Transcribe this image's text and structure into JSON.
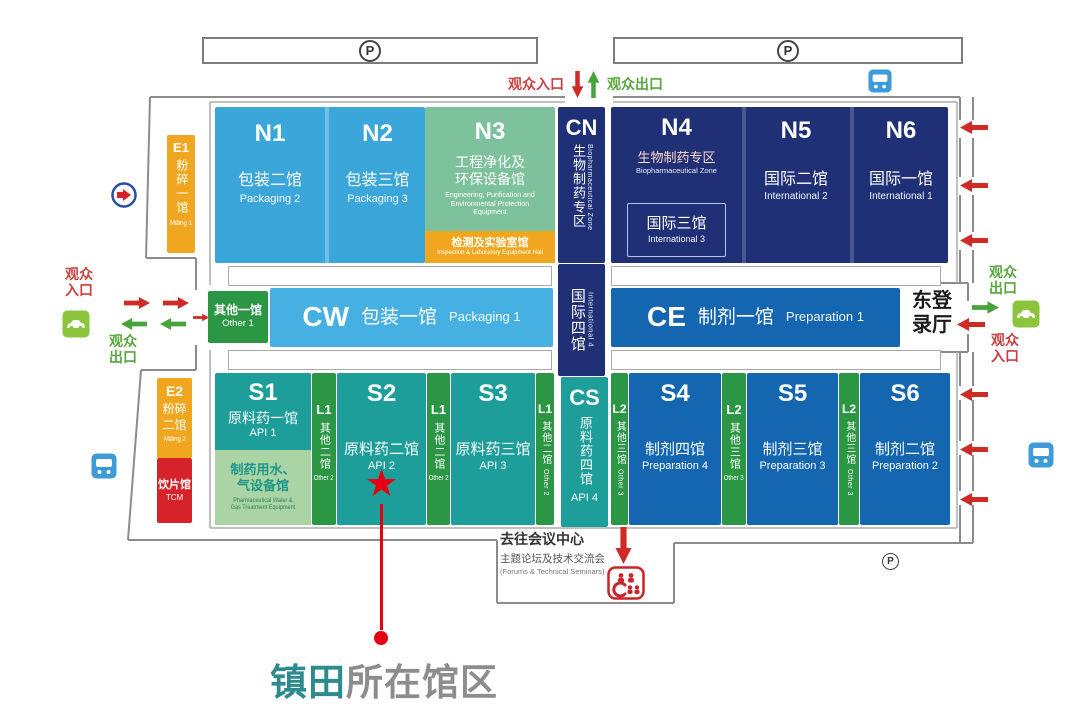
{
  "annotation": {
    "highlight": "镇田",
    "rest": "所在馆区"
  },
  "parking_label": "P",
  "icons": {
    "star": "★"
  },
  "labels": {
    "visitor_entrance": "观众入口",
    "visitor_exit": "观众出口",
    "visitor_entrance_l1": "观众",
    "visitor_entrance_l2": "入口",
    "visitor_exit_l1": "观众",
    "visitor_exit_l2": "出口",
    "east_hall_l1": "东登",
    "east_hall_l2": "录厅",
    "conference_title": "去往会议中心",
    "conference_sub": "主题论坛及技术交流会",
    "conference_en": "(Forums & Technical Seminars)"
  },
  "halls": {
    "e1": {
      "code": "E1",
      "name": "粉碎一馆",
      "en": "Milling 1"
    },
    "e2": {
      "code": "E2",
      "name_l1": "粉碎",
      "name_l2": "二馆",
      "en": "Milling 2"
    },
    "tcm": {
      "name": "饮片馆",
      "en": "TCM"
    },
    "n1": {
      "code": "N1",
      "name": "包装二馆",
      "en": "Packaging 2"
    },
    "n2": {
      "code": "N2",
      "name": "包装三馆",
      "en": "Packaging 3"
    },
    "n3": {
      "code": "N3",
      "name_l1": "工程净化及",
      "name_l2": "环保设备馆",
      "en": "Engineering, Purification and Environmental Protection Equipment"
    },
    "n3_sub": {
      "name": "检测及实验室馆",
      "en": "Inspection & Laboratory Equipment Hall"
    },
    "cn": {
      "code": "CN",
      "name": "生物制药专区",
      "en": "Biopharmaceutical Zone"
    },
    "n4": {
      "code": "N4",
      "zone": "生物制药专区",
      "zone_en": "Biopharmaceutical Zone",
      "sub": "国际三馆",
      "sub_en": "International 3"
    },
    "n5": {
      "code": "N5",
      "name": "国际二馆",
      "en": "International 2"
    },
    "n6": {
      "code": "N6",
      "name": "国际一馆",
      "en": "International 1"
    },
    "other1": {
      "name": "其他一馆",
      "en": "Other 1"
    },
    "cw": {
      "code": "CW",
      "name": "包装一馆",
      "en": "Packaging 1"
    },
    "int4": {
      "name": "国际四馆",
      "en": "International 4"
    },
    "ce": {
      "code": "CE",
      "name": "制剂一馆",
      "en": "Preparation 1"
    },
    "east": {
      "name": "东登录厅"
    },
    "s1": {
      "code": "S1",
      "name": "原料药一馆",
      "en": "API 1"
    },
    "s1_sub": {
      "name_l1": "制药用水、",
      "name_l2": "气设备馆",
      "en_l1": "Pharmaceutical Water &",
      "en_l2": "Gas Treatment Equipment"
    },
    "l1": {
      "code": "L1",
      "name": "其他二馆",
      "en": "Other 2"
    },
    "s2": {
      "code": "S2",
      "name": "原料药二馆",
      "en": "API 2"
    },
    "s3": {
      "code": "S3",
      "name": "原料药三馆",
      "en": "API 3"
    },
    "cs": {
      "code": "CS",
      "name": "原料药四馆",
      "en": "API 4"
    },
    "l2": {
      "code": "L2",
      "name": "其他三馆",
      "en": "Other 3"
    },
    "s4": {
      "code": "S4",
      "name": "制剂四馆",
      "en": "Preparation 4"
    },
    "s5": {
      "code": "S5",
      "name": "制剂三馆",
      "en": "Preparation 3"
    },
    "s6": {
      "code": "S6",
      "name": "制剂二馆",
      "en": "Preparation 2"
    }
  },
  "colors": {
    "packaging_blue": "#3aa6d9",
    "light_blue": "#45b0e1",
    "navy": "#203077",
    "prep_blue": "#1566b0",
    "teal": "#1d9e9b",
    "green": "#2b9643",
    "n3_green": "#7dc19d",
    "light_green": "#abd4a4",
    "orange": "#f0a71f",
    "tcm_red": "#d6232a",
    "marker_red": "#e60012",
    "entrance_red": "#c9403f",
    "exit_green": "#56a83c",
    "annotation_teal": "#2d8b8d",
    "annotation_gray": "#8d8d8d"
  }
}
